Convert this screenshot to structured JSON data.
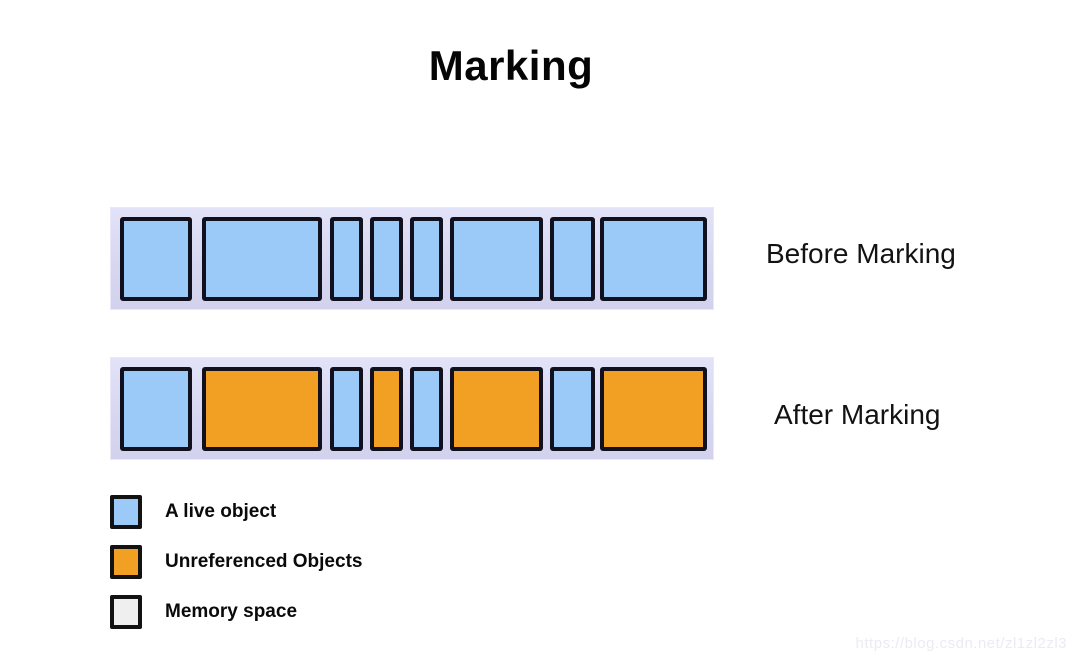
{
  "title": "Marking",
  "bars": {
    "layout": [
      {
        "left": 10,
        "width": 72
      },
      {
        "left": 92,
        "width": 120
      },
      {
        "left": 220,
        "width": 33
      },
      {
        "left": 260,
        "width": 33
      },
      {
        "left": 300,
        "width": 33
      },
      {
        "left": 340,
        "width": 93
      },
      {
        "left": 440,
        "width": 45
      },
      {
        "left": 490,
        "width": 107
      }
    ],
    "before": {
      "label": "Before Marking",
      "states": [
        "live",
        "live",
        "live",
        "live",
        "live",
        "live",
        "live",
        "live"
      ]
    },
    "after": {
      "label": "After Marking",
      "states": [
        "live",
        "unreferenced",
        "live",
        "unreferenced",
        "live",
        "unreferenced",
        "live",
        "unreferenced"
      ]
    }
  },
  "legend": {
    "items": [
      {
        "state": "live",
        "label": "A live object"
      },
      {
        "state": "unreferenced",
        "label": "Unreferenced Objects"
      },
      {
        "state": "memory",
        "label": "Memory space"
      }
    ]
  },
  "colors": {
    "live": "#9BCAF8",
    "unreferenced": "#F2A024",
    "memory": "#EFEFEF",
    "bar_background": "#D8D8F2",
    "box_border": "#10101E"
  },
  "watermark": "https://blog.csdn.net/zl1zl2zl3"
}
